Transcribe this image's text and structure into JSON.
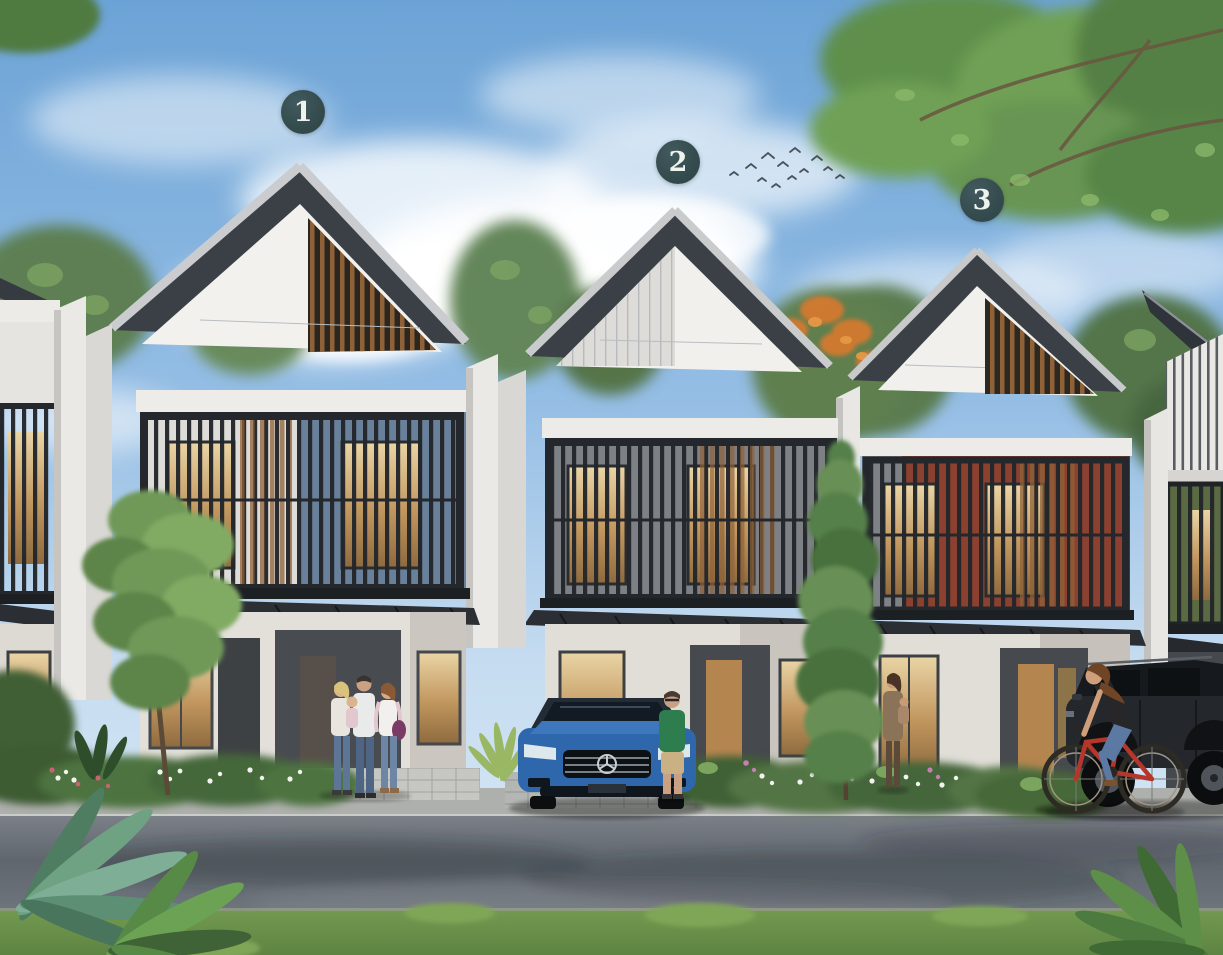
{
  "markers": {
    "items": [
      {
        "id": "house-1",
        "label": "1"
      },
      {
        "id": "house-2",
        "label": "2"
      },
      {
        "id": "house-3",
        "label": "3"
      }
    ]
  },
  "palette": {
    "marker_bg": "#32494c",
    "marker_fg": "#edf3ed",
    "accent_blue": "#68809a",
    "accent_rust": "#8c4130",
    "accent_green": "#5a6b43",
    "car_blue": "#2f67ad",
    "sky_top": "#6ca3d6",
    "roof_dark": "#3a4045",
    "wood": "#8f6137",
    "lawn_green": "#5e8443"
  }
}
